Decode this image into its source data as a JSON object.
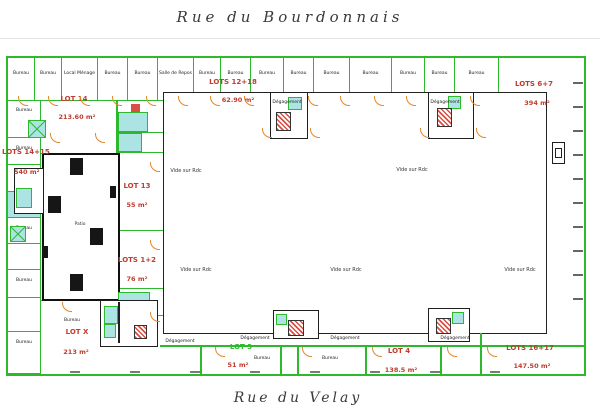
{
  "titles": {
    "top": "Rue du Bourdonnais",
    "bottom": "Rue du Velay"
  },
  "lots": [
    {
      "name": "LOT 14",
      "area": "213.60 m²"
    },
    {
      "name": "LOTS 14+15",
      "area": "540 m²"
    },
    {
      "name": "LOT 13",
      "area": "55 m²"
    },
    {
      "name": "LOTS 1+2",
      "area": "76 m²"
    },
    {
      "name": "LOTS 12+18",
      "area": "62.90 m²"
    },
    {
      "name": "LOTS 6+7",
      "area": "394 m²"
    },
    {
      "name": "LOT X",
      "area": "213 m²"
    },
    {
      "name": "LOT 3",
      "area": "51 m²"
    },
    {
      "name": "LOT 4",
      "area": "138.5 m²"
    },
    {
      "name": "LOTS 16+17",
      "area": "147.50 m²"
    }
  ],
  "labels": {
    "vide": "Vide sur Rdc",
    "patio": "Patio",
    "bureau": "Bureau",
    "degagement": "Dégagement",
    "local_menage": "Local Ménage",
    "salle_repos": "Salle de Repos"
  },
  "colors": {
    "wall": "#2eb82e",
    "structure": "#1f1f1f",
    "lot_text": "#c23b2e",
    "service": "#ace4e4",
    "door": "#e0892f",
    "stair": "#d94f43"
  }
}
